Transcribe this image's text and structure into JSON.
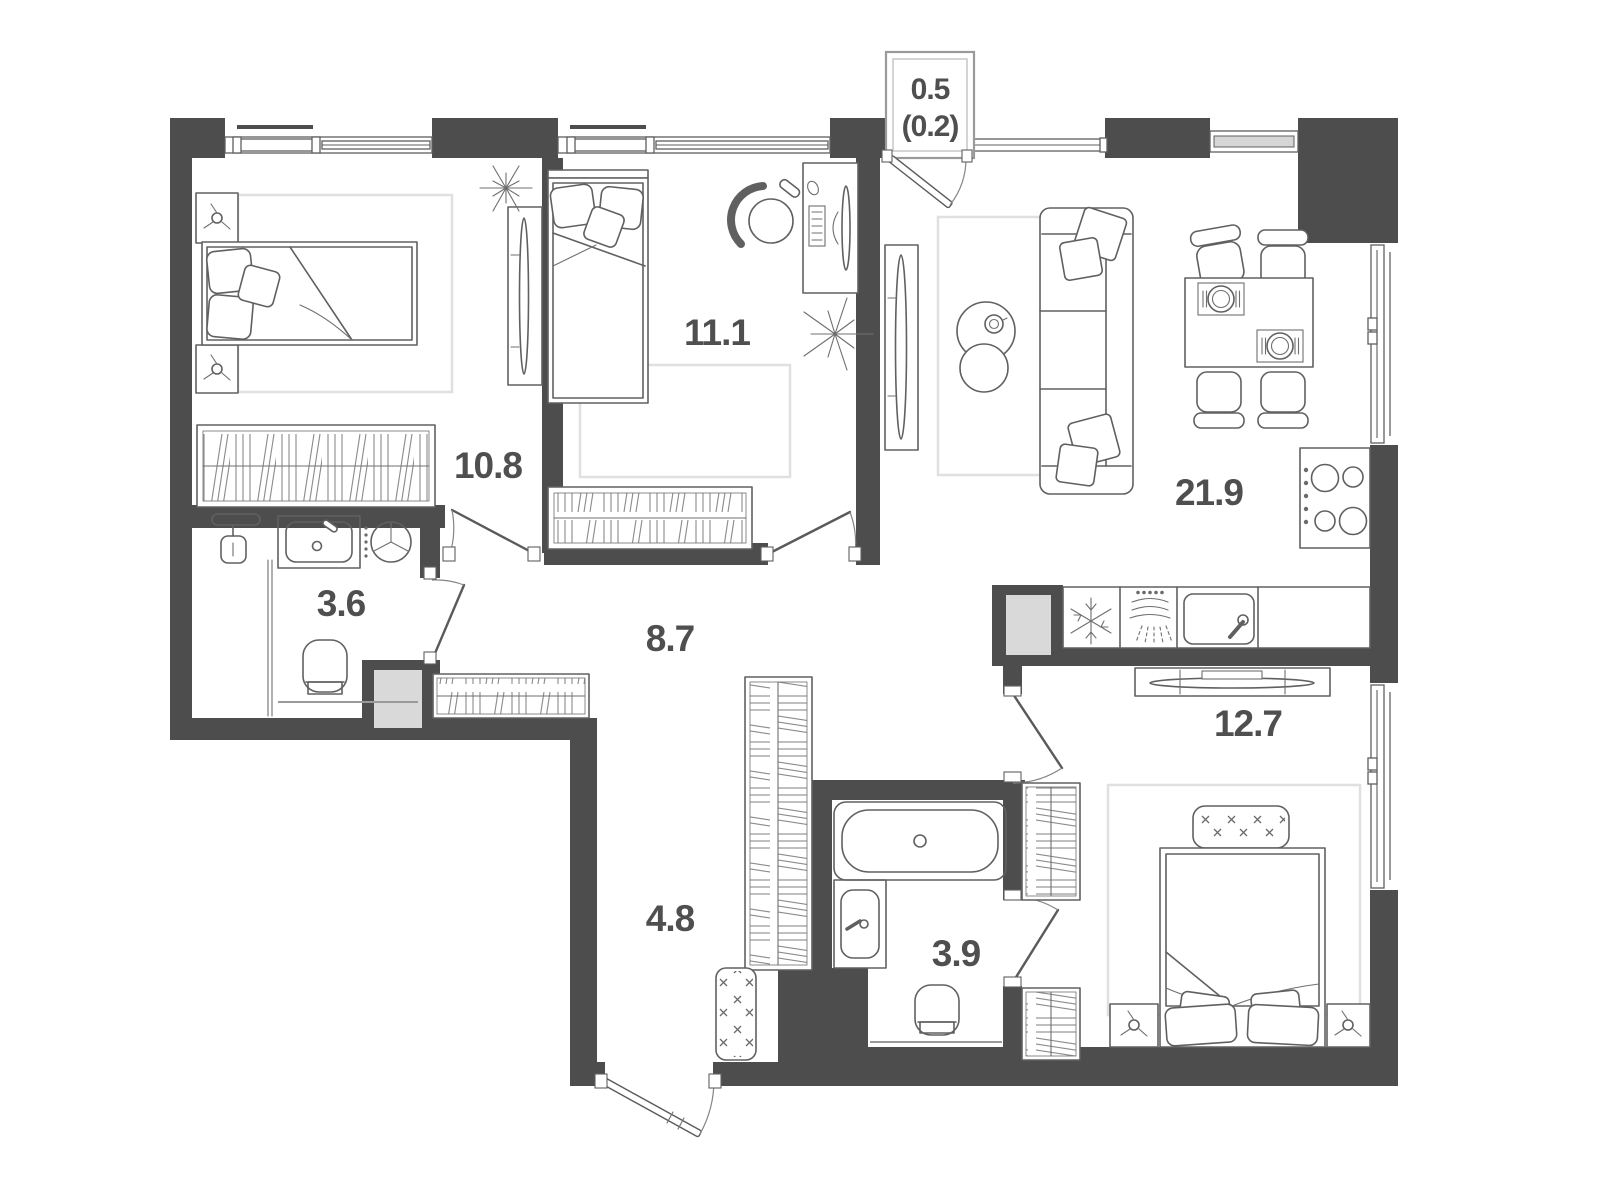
{
  "plan": {
    "type": "apartment-floor-plan",
    "balcony": {
      "area": "0.5",
      "area_secondary": "(0.2)"
    },
    "rooms": {
      "bedroom_top_left": {
        "area": "10.8"
      },
      "bedroom_top_middle": {
        "area": "11.1"
      },
      "living_kitchen": {
        "area": "21.9"
      },
      "bathroom_left": {
        "area": "3.6"
      },
      "hallway": {
        "area": "8.7"
      },
      "corridor": {
        "area": "4.8"
      },
      "bathroom_right": {
        "area": "3.9"
      },
      "bedroom_bottom_right": {
        "area": "12.7"
      }
    },
    "colors": {
      "wall": "#4d4d4d",
      "furniture_line": "#606060",
      "shaft_fill": "#d9d9d9",
      "glass_fill": "#d6d6d6",
      "label": "#4f4f4f",
      "background": "#ffffff"
    }
  }
}
